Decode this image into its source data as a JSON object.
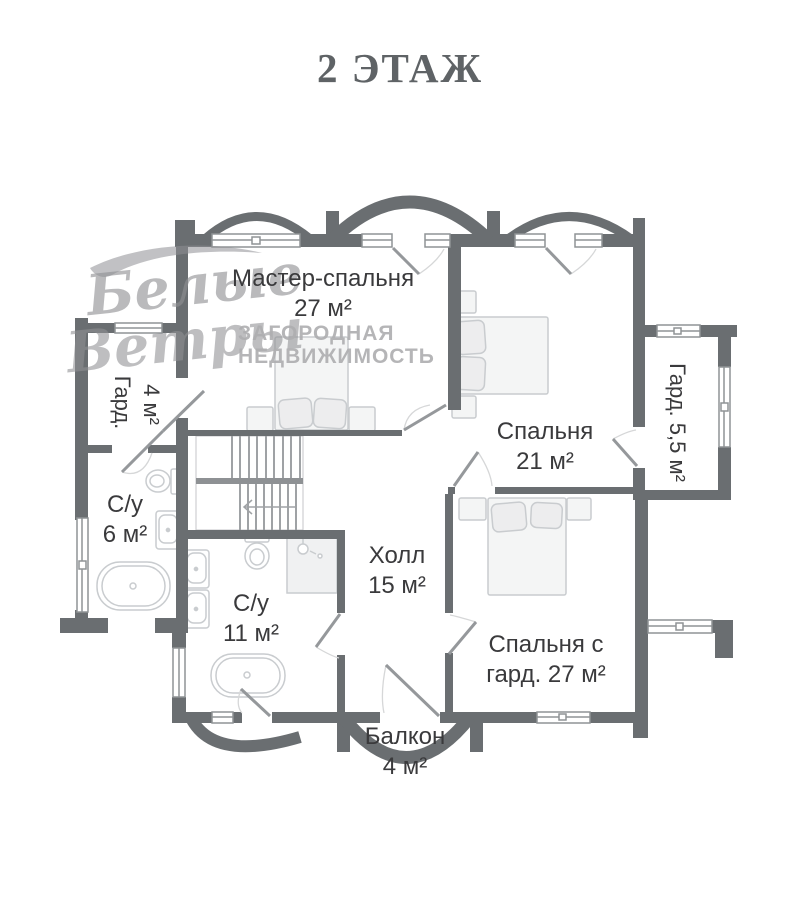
{
  "title": "2 ЭТАЖ",
  "watermark": {
    "script_line1": "Белые",
    "script_line2": "Ветры",
    "caption_line1": "ЗАГОРОДНАЯ",
    "caption_line2": "НЕДВИЖИМОСТЬ"
  },
  "rooms": {
    "master": {
      "name": "Мастер-спальня",
      "area": "27 м²"
    },
    "bedroom": {
      "name": "Спальня",
      "area": "21 м²"
    },
    "wardrobe_left": {
      "name": "Гард.",
      "area": "4 м²"
    },
    "bathroom_small": {
      "name": "С/у",
      "area": "6 м²"
    },
    "bathroom_large": {
      "name": "С/у",
      "area": "11 м²"
    },
    "hall": {
      "name": "Холл",
      "area": "15 м²"
    },
    "bedroom_wardrobe": {
      "line1": "Спальня с",
      "line2": "гард. 27 м²"
    },
    "wardrobe_right": {
      "label": "Гард. 5,5 м²"
    },
    "balcony": {
      "name": "Балкон",
      "area": "4 м²"
    }
  },
  "colors": {
    "wall": "#6a6e71",
    "label": "#3a3a3c",
    "accent_furniture": "#c9cccf"
  }
}
